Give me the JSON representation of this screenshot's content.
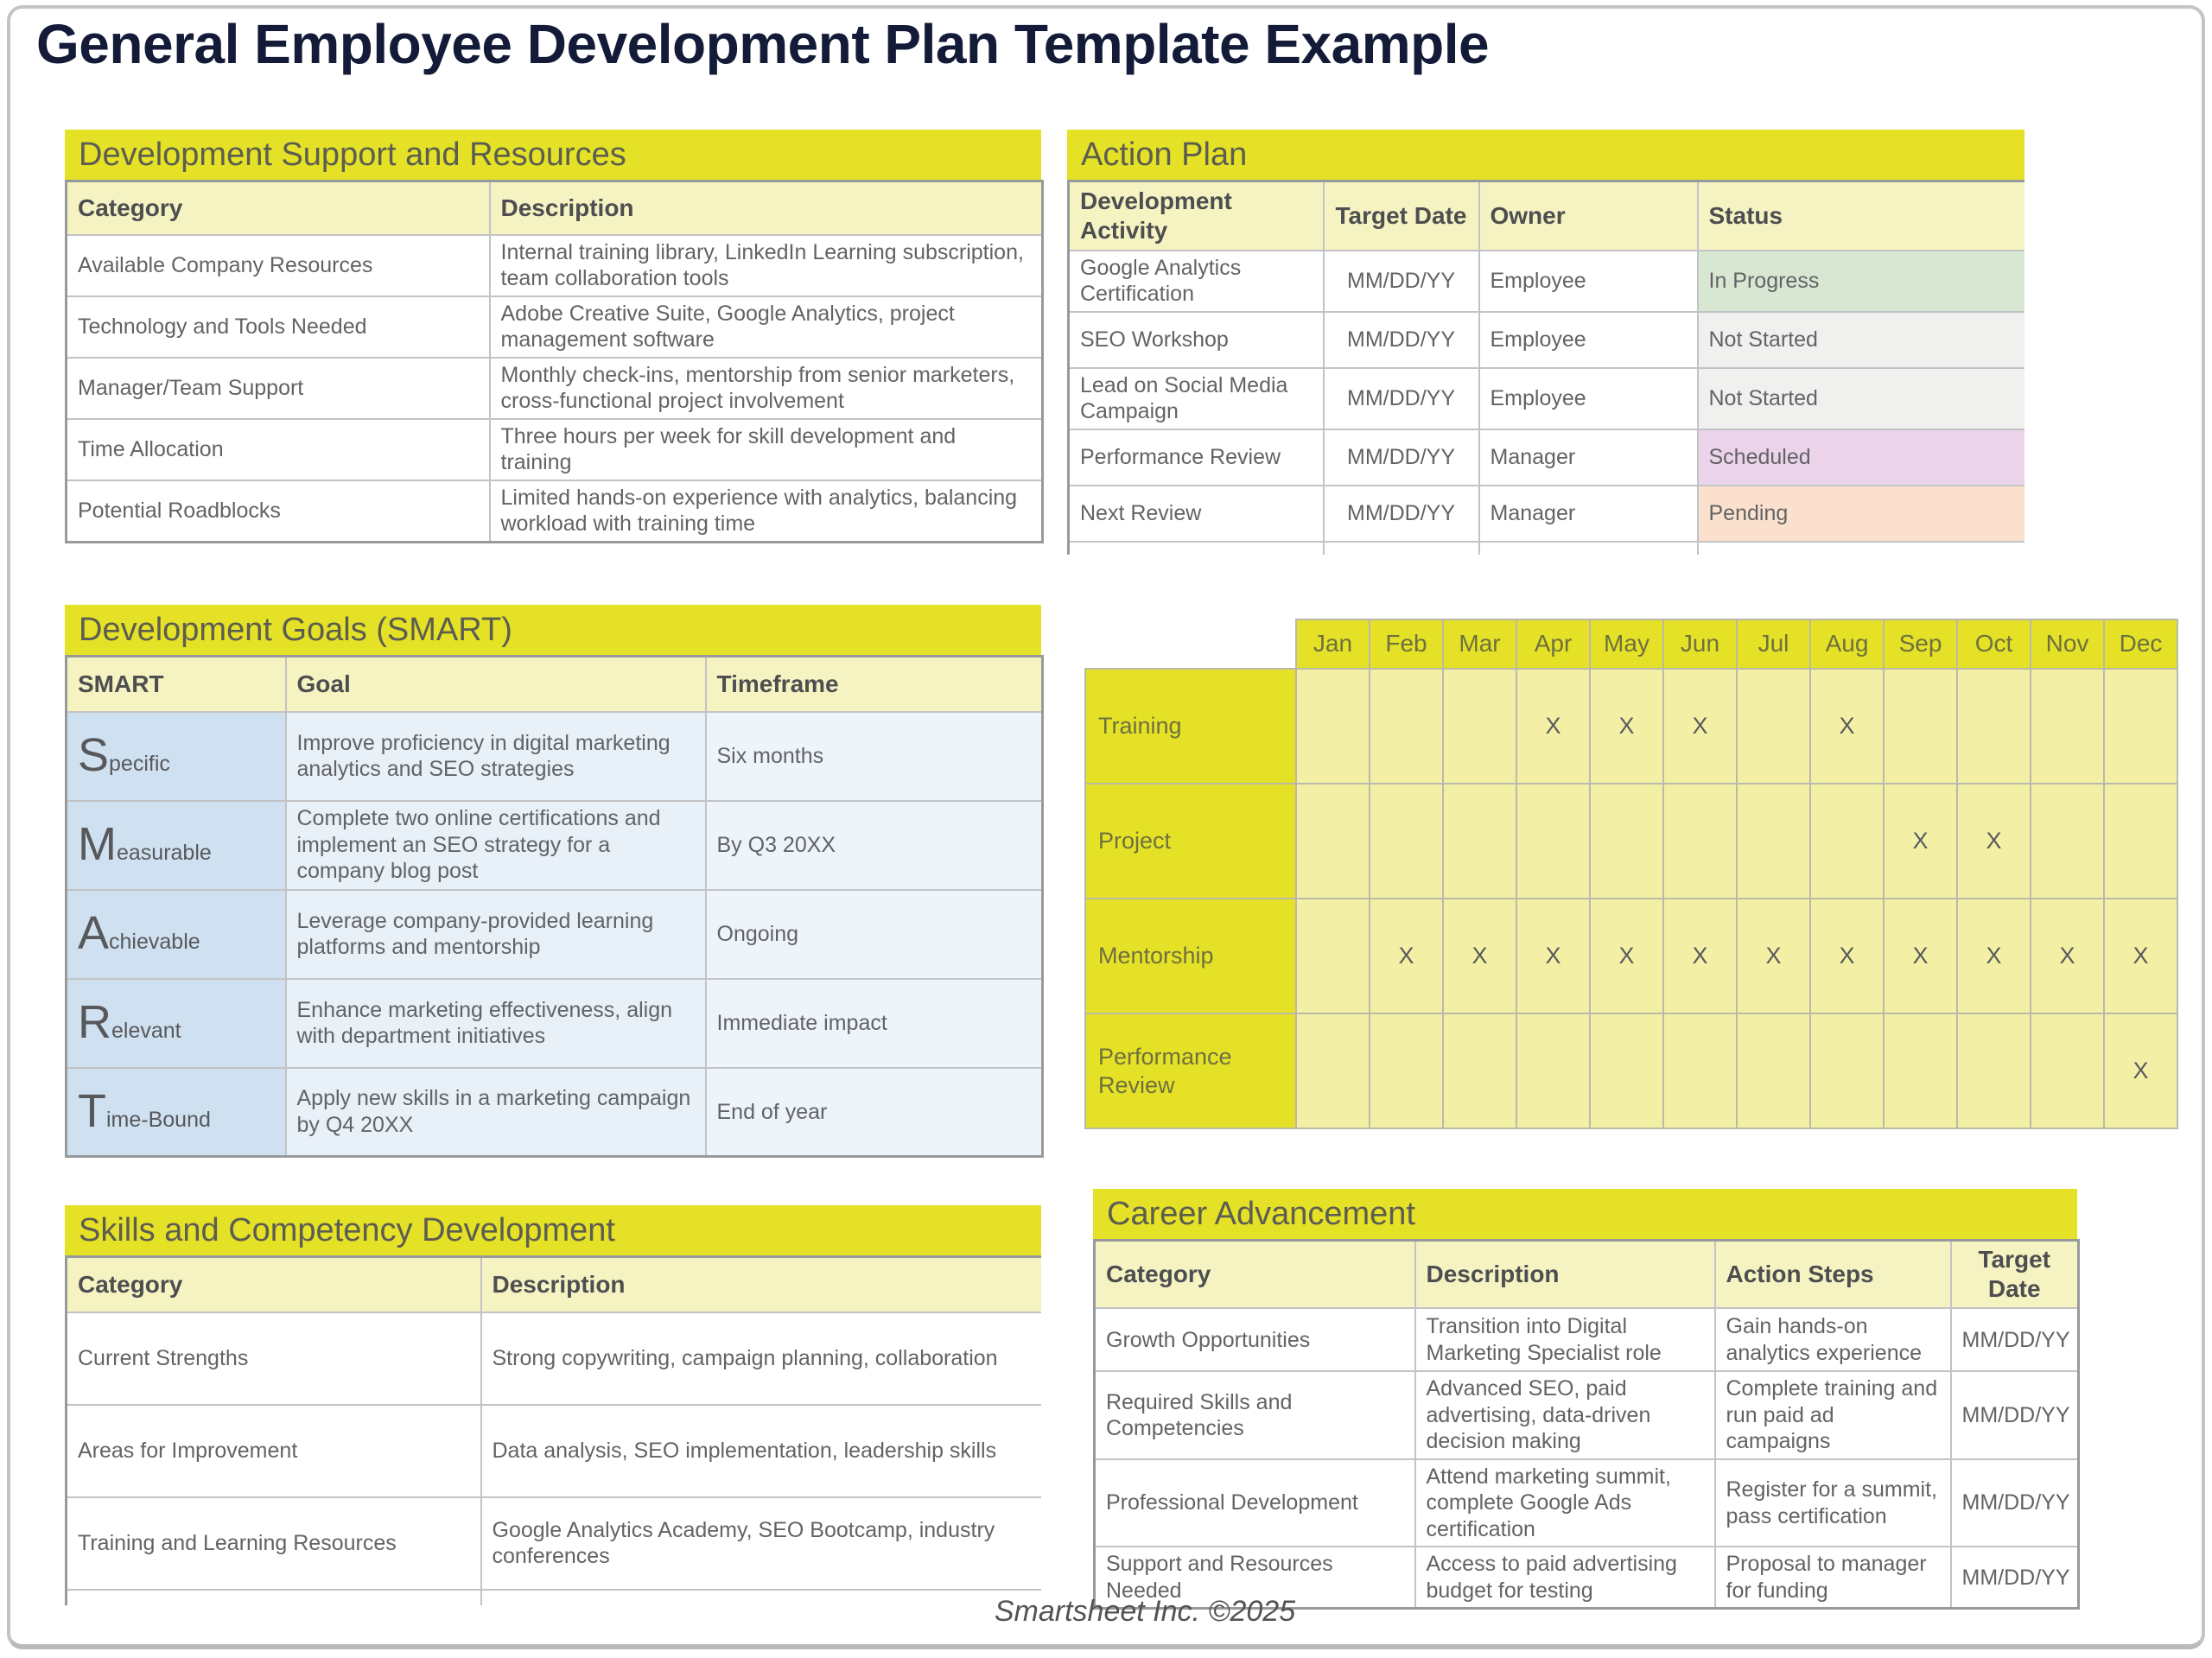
{
  "page": {
    "title": "General Employee Development Plan Template Example",
    "footer": "Smartsheet Inc. ©2025"
  },
  "colors": {
    "brand_yellow": "#e5e126",
    "pale_yellow_header": "#f6f3c3",
    "grid_cell_yellow": "#f3f0a6",
    "title_navy": "#141b38",
    "status_in_progress": "#d8e7d1",
    "status_not_started": "#f0f0ef",
    "status_scheduled": "#ebd3e9",
    "status_pending": "#fbe1cd",
    "smart_column_blue": "#cfe0f0",
    "goal_column_blue": "#e8f0f8",
    "timeframe_column_blue": "#edf4fa"
  },
  "dev_support": {
    "title": "Development Support and Resources",
    "headers": [
      "Category",
      "Description"
    ],
    "rows": [
      [
        "Available Company Resources",
        "Internal training library, LinkedIn Learning subscription, team collaboration tools"
      ],
      [
        "Technology and Tools Needed",
        "Adobe Creative Suite, Google Analytics, project management software"
      ],
      [
        "Manager/Team Support",
        "Monthly check-ins, mentorship from senior marketers, cross-functional project involvement"
      ],
      [
        "Time Allocation",
        "Three hours per week for skill development and training"
      ],
      [
        "Potential Roadblocks",
        "Limited hands-on experience with analytics, balancing workload with training time"
      ]
    ]
  },
  "action_plan": {
    "title": "Action Plan",
    "headers": [
      "Development Activity",
      "Target Date",
      "Owner",
      "Status"
    ],
    "rows": [
      {
        "activity": "Google Analytics Certification",
        "target_date": "MM/DD/YY",
        "owner": "Employee",
        "status": "In Progress",
        "status_bg": "#d8e7d1"
      },
      {
        "activity": "SEO Workshop",
        "target_date": "MM/DD/YY",
        "owner": "Employee",
        "status": "Not Started",
        "status_bg": "#f0f0ef"
      },
      {
        "activity": "Lead on Social Media Campaign",
        "target_date": "MM/DD/YY",
        "owner": "Employee",
        "status": "Not Started",
        "status_bg": "#f0f0ef"
      },
      {
        "activity": "Performance Review",
        "target_date": "MM/DD/YY",
        "owner": "Manager",
        "status": "Scheduled",
        "status_bg": "#ebd3e9"
      },
      {
        "activity": "Next Review",
        "target_date": "MM/DD/YY",
        "owner": "Manager",
        "status": "Pending",
        "status_bg": "#fbe1cd"
      }
    ]
  },
  "smart_goals": {
    "title": "Development Goals (SMART)",
    "headers": [
      "SMART",
      "Goal",
      "Timeframe"
    ],
    "rows": [
      {
        "letter": "S",
        "rest": "pecific",
        "goal": "Improve proficiency in digital marketing analytics and SEO strategies",
        "timeframe": "Six months"
      },
      {
        "letter": "M",
        "rest": "easurable",
        "goal": "Complete two online certifications and implement an SEO strategy for a company blog post",
        "timeframe": "By Q3 20XX"
      },
      {
        "letter": "A",
        "rest": "chievable",
        "goal": "Leverage company-provided learning platforms and mentorship",
        "timeframe": "Ongoing"
      },
      {
        "letter": "R",
        "rest": "elevant",
        "goal": "Enhance marketing effectiveness, align with department initiatives",
        "timeframe": "Immediate impact"
      },
      {
        "letter": "T",
        "rest": "ime-Bound",
        "goal": "Apply new skills in a marketing campaign by Q4 20XX",
        "timeframe": "End of year"
      }
    ]
  },
  "schedule": {
    "months": [
      "Jan",
      "Feb",
      "Mar",
      "Apr",
      "May",
      "Jun",
      "Jul",
      "Aug",
      "Sep",
      "Oct",
      "Nov",
      "Dec"
    ],
    "rows": [
      {
        "label": "Training",
        "marks": [
          "",
          "",
          "",
          "X",
          "X",
          "X",
          "",
          "X",
          "",
          "",
          "",
          ""
        ]
      },
      {
        "label": "Project",
        "marks": [
          "",
          "",
          "",
          "",
          "",
          "",
          "",
          "",
          "X",
          "X",
          "",
          ""
        ]
      },
      {
        "label": "Mentorship",
        "marks": [
          "",
          "X",
          "X",
          "X",
          "X",
          "X",
          "X",
          "X",
          "X",
          "X",
          "X",
          "X"
        ]
      },
      {
        "label": "Performance Review",
        "marks": [
          "",
          "",
          "",
          "",
          "",
          "",
          "",
          "",
          "",
          "",
          "",
          "X"
        ]
      }
    ]
  },
  "skills": {
    "title": "Skills and Competency Development",
    "headers": [
      "Category",
      "Description"
    ],
    "rows": [
      [
        "Current Strengths",
        "Strong copywriting, campaign planning, collaboration"
      ],
      [
        "Areas for Improvement",
        "Data analysis, SEO implementation, leadership skills"
      ],
      [
        "Training and Learning Resources",
        "Google Analytics Academy, SEO Bootcamp, industry conferences"
      ]
    ]
  },
  "career": {
    "title": "Career Advancement",
    "headers": [
      "Category",
      "Description",
      "Action Steps",
      "Target Date"
    ],
    "rows": [
      [
        "Growth Opportunities",
        "Transition into Digital Marketing Specialist role",
        "Gain hands-on analytics experience",
        "MM/DD/YY"
      ],
      [
        "Required Skills and Competencies",
        "Advanced SEO, paid advertising, data-driven decision making",
        "Complete training and run paid ad campaigns",
        "MM/DD/YY"
      ],
      [
        "Professional Development",
        "Attend marketing summit, complete Google Ads certification",
        "Register for a summit, pass certification",
        "MM/DD/YY"
      ],
      [
        "Support and Resources Needed",
        "Access to paid advertising budget for testing",
        "Proposal to manager for funding",
        "MM/DD/YY"
      ]
    ]
  }
}
